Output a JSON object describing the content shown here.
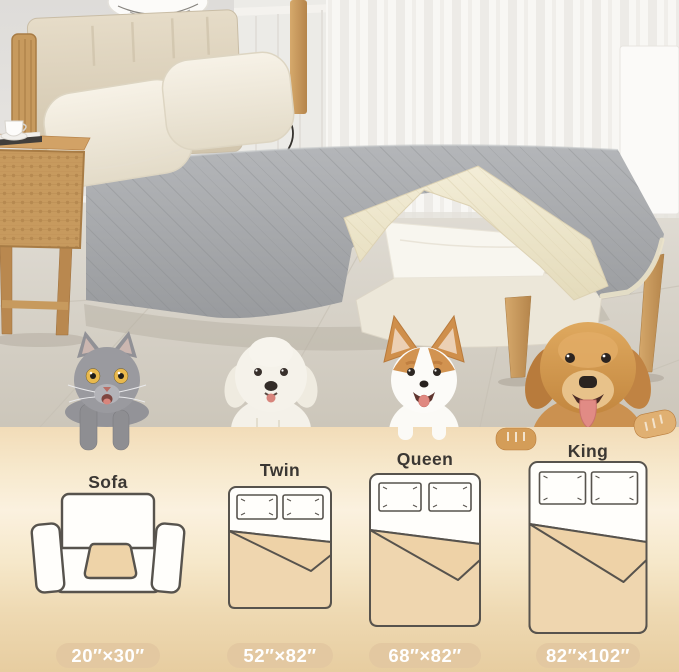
{
  "size_chart": {
    "items": [
      {
        "label": "Sofa",
        "dimensions": "20″×30″"
      },
      {
        "label": "Twin",
        "dimensions": "52″×82″"
      },
      {
        "label": "Queen",
        "dimensions": "68″×82″"
      },
      {
        "label": "King",
        "dimensions": "82″×102″"
      }
    ]
  },
  "pets": [
    "gray-cat",
    "white-fluffy-dog",
    "corgi",
    "golden-retriever"
  ],
  "colors": {
    "panel_gradient_top": "#f2dcb8",
    "panel_gradient_light": "#fbf1df",
    "panel_gradient_bottom": "#e7cda0",
    "pill_background": "#e3c8a1",
    "pill_text": "#ffffff",
    "diagram_outline": "#57534d",
    "diagram_tan": "#eed3a8",
    "label_text": "#3b3733",
    "blanket_gray": "#a9abae",
    "blanket_cream": "#ece4cb",
    "wood": "#c89a5e"
  }
}
